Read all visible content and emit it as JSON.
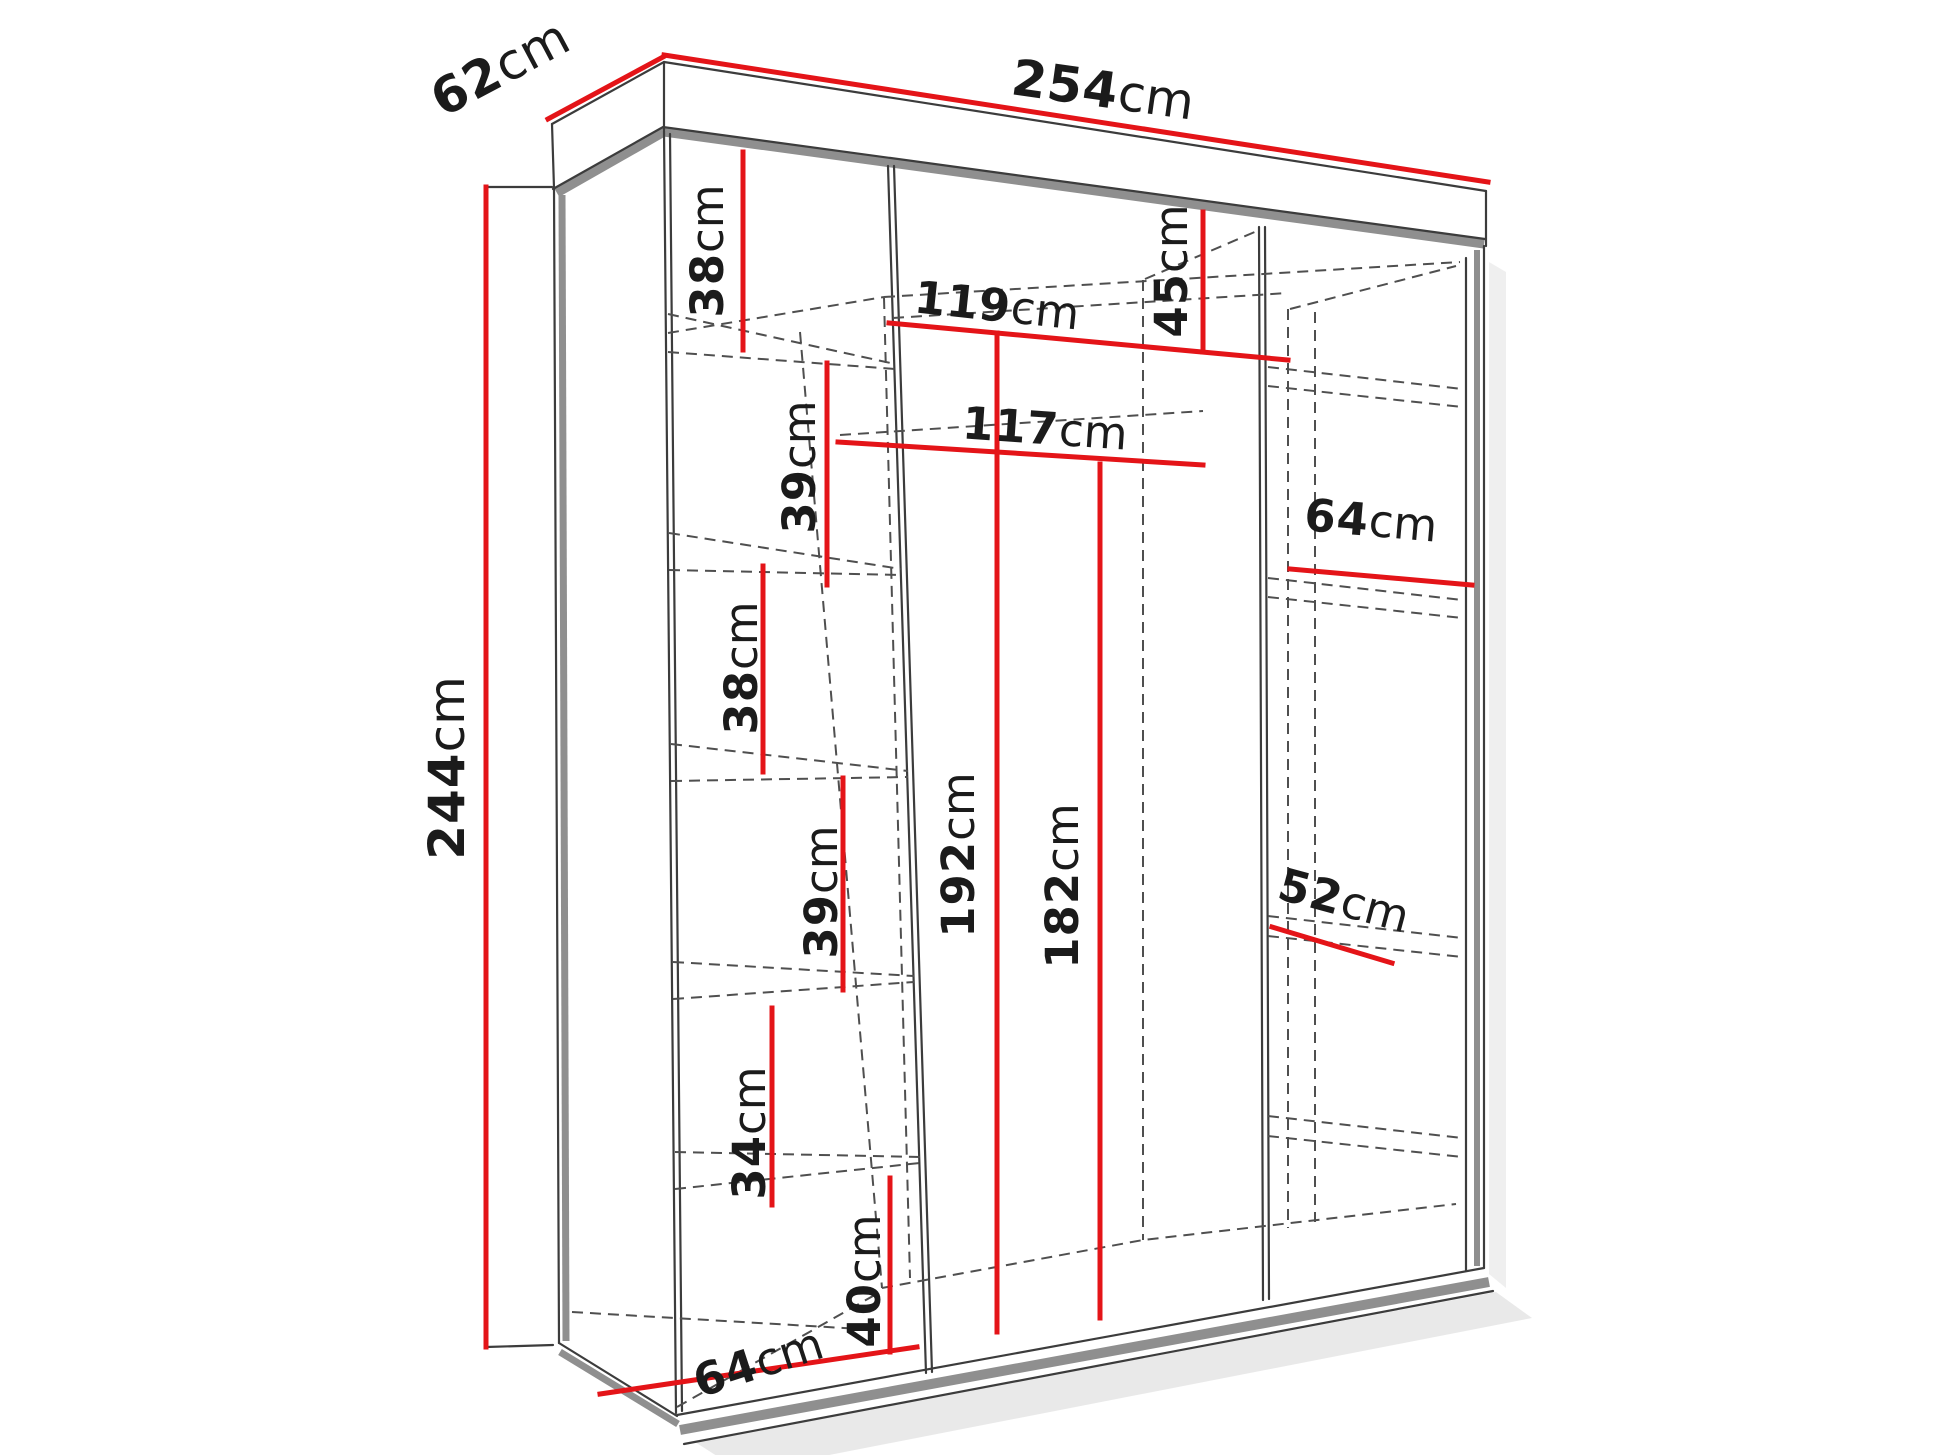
{
  "diagram": {
    "name": "wardrobe-dimensions-diagram",
    "background": "#ffffff",
    "accent_color": "#e41418",
    "line_color": "#3c3c3c",
    "text_color": "#1b1b1b"
  },
  "dimensions": {
    "depth": {
      "value": "62",
      "unit": "cm"
    },
    "width": {
      "value": "254",
      "unit": "cm"
    },
    "height": {
      "value": "244",
      "unit": "cm"
    },
    "left_column_shelves": [
      {
        "value": "38",
        "unit": "cm"
      },
      {
        "value": "39",
        "unit": "cm"
      },
      {
        "value": "38",
        "unit": "cm"
      },
      {
        "value": "39",
        "unit": "cm"
      },
      {
        "value": "34",
        "unit": "cm"
      },
      {
        "value": "40",
        "unit": "cm"
      }
    ],
    "bottom_depth": {
      "value": "64",
      "unit": "cm"
    },
    "middle_top_width": {
      "value": "119",
      "unit": "cm"
    },
    "middle_inner_width": {
      "value": "117",
      "unit": "cm"
    },
    "middle_top_height": {
      "value": "45",
      "unit": "cm"
    },
    "hanging_height_front": {
      "value": "192",
      "unit": "cm"
    },
    "hanging_height_back": {
      "value": "182",
      "unit": "cm"
    },
    "right_shelf_width": {
      "value": "64",
      "unit": "cm"
    },
    "right_shelf_depth": {
      "value": "52",
      "unit": "cm"
    }
  }
}
